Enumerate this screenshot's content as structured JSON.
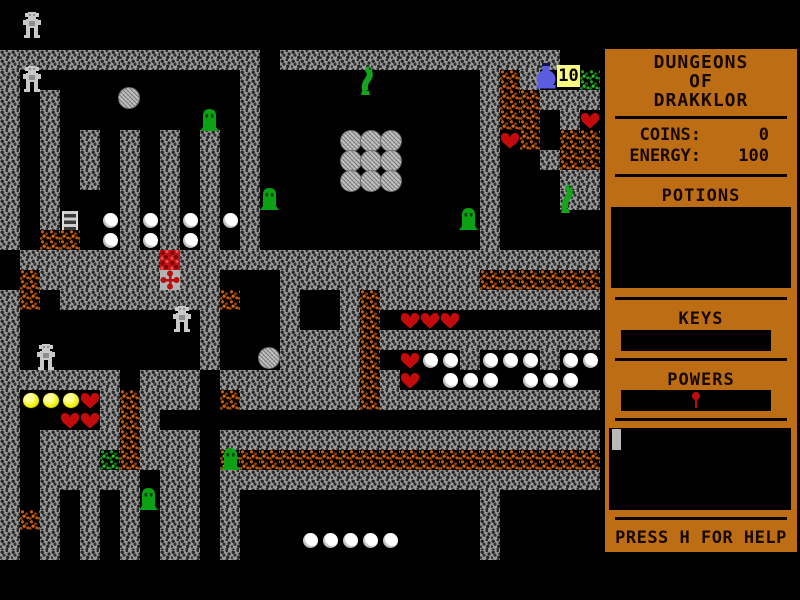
{
  "sidebar": {
    "title_lines": [
      "DUNGEONS",
      "OF",
      "DRAKKLOR"
    ],
    "stats": [
      {
        "label": "COINS:",
        "value": "0"
      },
      {
        "label": "ENERGY:",
        "value": "100"
      }
    ],
    "sections": {
      "potions": "POTIONS",
      "keys": "KEYS",
      "powers": "POWERS"
    },
    "help_text": "PRESS H FOR HELP",
    "panel_color": "#bd6e15",
    "text_color": "#170800"
  },
  "hud": {
    "flask_count": "10"
  },
  "colors": {
    "wall": "#999999",
    "floor": "#000000",
    "rough_orange": "#c45a10",
    "rough_green": "#1fa41f",
    "lava": "#bf1212",
    "heart": "#c40a0a",
    "orb": "#ffffff",
    "gold_orb": "#f0f000",
    "slime": "#0ca114",
    "flask": "#5c5ce0",
    "badge_bg": "#fafa7e"
  },
  "map": {
    "tile_px": 20,
    "origin_x": 0,
    "origin_y": 10,
    "cols": 30,
    "rows": 28,
    "legend": {
      "W": "wall",
      "B": "floor",
      "O": "rough-orange",
      "G": "rough-green",
      "R": "lava-tile",
      "X": "cross-plate",
      "L": "ladder"
    },
    "grid": [
      "BBBBBBBBBBBBBBBBBBBBBBBBBBBBBB",
      "BBBBBBBBBBBBBBBBBBBBBBBBBBBBBB",
      "WWWWWWWWWWWWWBWWWWWWWWWWWWWWBB",
      "WBBBBBBBBBBBWBBBBBBBBBBBWOWBBG",
      "WBWBBBBBBBBBWBBBBBBBBBBBWOOWWW",
      "WBWBBBBBBBBBWBBBBBBBBBBBWOOBWB",
      "WBWBWBWBWBWBWBBBBBBBBBBBWBOBOO",
      "WBWBWBWBWBWBWBBBBBBBBBBBWBBWOO",
      "WBWBWBWBWBWBWBBBBBBBBBBBWBBBWW",
      "WBWBBBWBWBWBWBBBBBBBBBBBWBBBWW",
      "WBWLBBWBWBWBWBBBBBBBBBBBWBBBBB",
      "WBOOBBWBWBWBWBBBBBBBBBBBWBBBBB",
      "BWWWWWWWRWWWWWWWWWWWWWWWWWWWWW",
      "BOWWWWWWXWWBBBWWWWWWWWWWOOOOOO",
      "WOBWWWWWWWWOBBWBBWOWWWWWWWWWWW",
      "WBBBBBBBBBWBBBWBBWOBBBBBBBBBBB",
      "WBBBBBBBBBWBBBWWWWOWWWWWWWWWWW",
      "WBBBBBBBBBWBBBWWWWOBBBBWBBBWBB",
      "WWWWWWBWWWBWWWWWWWOWBBBBBBBBBB",
      "WBBBBWOWWWBOWWWWWWOWWWWWWWWWWW",
      "WBBBBWOWBBBBBBBBBBBBBBBBBBBBBB",
      "WBWWWWOWWWBWWWWWWWWWWWWWWWWWWW",
      "WBWWWGOWWWBOOOOOOOOOOOOOOOOOOO",
      "WBWWWWWBWWBWWWWWWWWWWWWWWWWWWW",
      "WBWBWBWBWWBWBBBBBBBBBBBBWBBBBB",
      "WOWBWBWBWWBWBBBBBBBBBBBBWBBBBB",
      "WBWBWBWBWWBWBBBBBBBBBBBBWBBBBB",
      "WBWBWBWBWWBWBBBBBBBBBBBBWBBBBB"
    ],
    "items": [
      {
        "t": "golem",
        "x": 22,
        "y": 12
      },
      {
        "t": "golem",
        "x": 22,
        "y": 66
      },
      {
        "t": "golem",
        "x": 172,
        "y": 306
      },
      {
        "t": "golem",
        "x": 36,
        "y": 344
      },
      {
        "t": "boulder",
        "x": 118,
        "y": 87
      },
      {
        "t": "boulder",
        "c": 17,
        "r": 6
      },
      {
        "t": "boulder",
        "c": 18,
        "r": 6
      },
      {
        "t": "boulder",
        "c": 19,
        "r": 6
      },
      {
        "t": "boulder",
        "c": 17,
        "r": 7
      },
      {
        "t": "boulder",
        "c": 18,
        "r": 7
      },
      {
        "t": "boulder",
        "c": 19,
        "r": 7
      },
      {
        "t": "boulder",
        "c": 17,
        "r": 8
      },
      {
        "t": "boulder",
        "c": 18,
        "r": 8
      },
      {
        "t": "boulder",
        "c": 19,
        "r": 8
      },
      {
        "t": "boulder",
        "x": 258,
        "y": 347
      },
      {
        "t": "slime",
        "x": 200,
        "y": 107
      },
      {
        "t": "slime",
        "x": 260,
        "y": 186
      },
      {
        "t": "slime",
        "x": 459,
        "y": 206
      },
      {
        "t": "slime",
        "x": 221,
        "y": 446
      },
      {
        "t": "slime",
        "x": 139,
        "y": 486
      },
      {
        "t": "snake",
        "x": 356,
        "y": 66
      },
      {
        "t": "snake",
        "x": 556,
        "y": 184
      },
      {
        "t": "orb",
        "c": 5,
        "r": 10
      },
      {
        "t": "orb",
        "c": 7,
        "r": 10
      },
      {
        "t": "orb",
        "c": 9,
        "r": 10
      },
      {
        "t": "orb",
        "c": 11,
        "r": 10
      },
      {
        "t": "orb",
        "c": 5,
        "r": 11
      },
      {
        "t": "orb",
        "c": 7,
        "r": 11
      },
      {
        "t": "orb",
        "c": 9,
        "r": 11
      },
      {
        "t": "orb",
        "c": 21,
        "r": 17
      },
      {
        "t": "orb",
        "c": 22,
        "r": 17
      },
      {
        "t": "orb",
        "c": 24,
        "r": 17
      },
      {
        "t": "orb",
        "c": 25,
        "r": 17
      },
      {
        "t": "orb",
        "c": 26,
        "r": 17
      },
      {
        "t": "orb",
        "c": 28,
        "r": 17
      },
      {
        "t": "orb",
        "c": 29,
        "r": 17
      },
      {
        "t": "orb",
        "c": 22,
        "r": 18
      },
      {
        "t": "orb",
        "c": 23,
        "r": 18
      },
      {
        "t": "orb",
        "c": 24,
        "r": 18
      },
      {
        "t": "orb",
        "c": 26,
        "r": 18
      },
      {
        "t": "orb",
        "c": 27,
        "r": 18
      },
      {
        "t": "orb",
        "c": 28,
        "r": 18
      },
      {
        "t": "orb",
        "c": 15,
        "r": 26
      },
      {
        "t": "orb",
        "c": 16,
        "r": 26
      },
      {
        "t": "orb",
        "c": 17,
        "r": 26
      },
      {
        "t": "orb",
        "c": 18,
        "r": 26
      },
      {
        "t": "orb",
        "c": 19,
        "r": 26
      },
      {
        "t": "heart",
        "c": 29,
        "r": 5
      },
      {
        "t": "heart",
        "c": 25,
        "r": 6
      },
      {
        "t": "heart",
        "c": 20,
        "r": 15
      },
      {
        "t": "heart",
        "c": 21,
        "r": 15
      },
      {
        "t": "heart",
        "c": 22,
        "r": 15
      },
      {
        "t": "heart",
        "c": 20,
        "r": 17
      },
      {
        "t": "heart",
        "c": 20,
        "r": 18
      },
      {
        "t": "heart",
        "c": 4,
        "r": 19
      },
      {
        "t": "heart",
        "c": 3,
        "r": 20
      },
      {
        "t": "heart",
        "c": 4,
        "r": 20
      },
      {
        "t": "gold",
        "c": 1,
        "r": 19
      },
      {
        "t": "gold",
        "c": 2,
        "r": 19
      },
      {
        "t": "gold",
        "c": 3,
        "r": 19
      }
    ]
  }
}
